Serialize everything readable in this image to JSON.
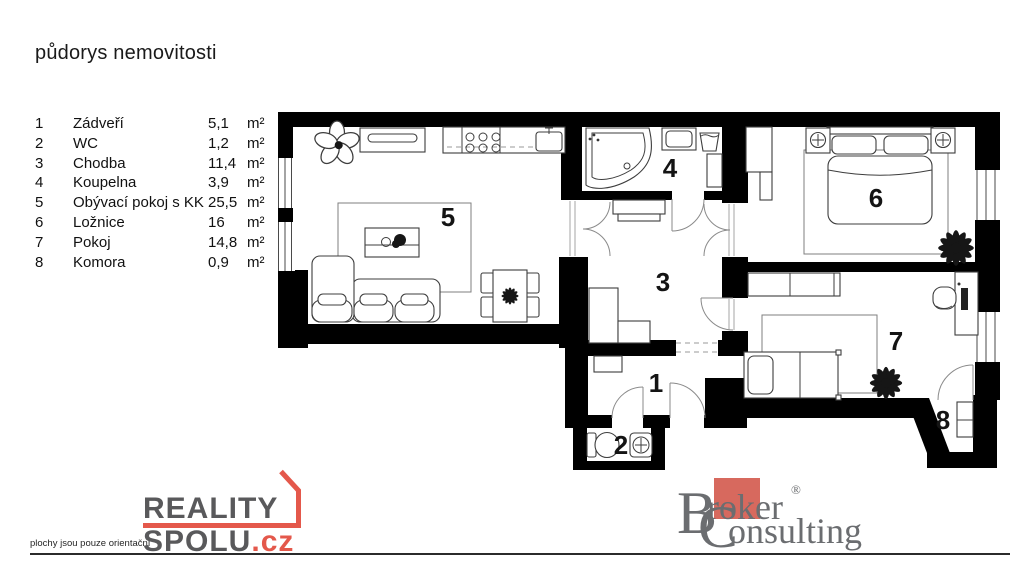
{
  "title": "půdorys nemovitosti",
  "legend": {
    "rows": [
      {
        "num": "1",
        "name": "Zádveří",
        "value": "5,1",
        "unit": "m²"
      },
      {
        "num": "2",
        "name": "WC",
        "value": "1,2",
        "unit": "m²"
      },
      {
        "num": "3",
        "name": "Chodba",
        "value": "11,4",
        "unit": "m²"
      },
      {
        "num": "4",
        "name": "Koupelna",
        "value": "3,9",
        "unit": "m²"
      },
      {
        "num": "5",
        "name": "Obývací pokoj s KK",
        "value": "25,5",
        "unit": "m²"
      },
      {
        "num": "6",
        "name": "Ložnice",
        "value": "16",
        "unit": "m²"
      },
      {
        "num": "7",
        "name": "Pokoj",
        "value": "14,8",
        "unit": "m²"
      },
      {
        "num": "8",
        "name": "Komora",
        "value": "0,9",
        "unit": "m²"
      }
    ]
  },
  "plan": {
    "labels": {
      "r1": "1",
      "r2": "2",
      "r3": "3",
      "r4": "4",
      "r5": "5",
      "r6": "6",
      "r7": "7",
      "r8": "8"
    }
  },
  "footer": {
    "disclaimer": "plochy jsou pouze orientační",
    "reality_logo": {
      "word1": "REALITY",
      "word2": "SPOLU",
      "tld": ".cz"
    },
    "broker_logo": {
      "b": "B",
      "roker": "roker",
      "reg": "®",
      "c": "C",
      "onsulting": "onsulting"
    }
  },
  "colors": {
    "walls": "#000000",
    "reality_gray": "#59595b",
    "reality_red": "#e4584b",
    "broker_gray": "#6b6d70",
    "broker_red": "#d7695e"
  }
}
